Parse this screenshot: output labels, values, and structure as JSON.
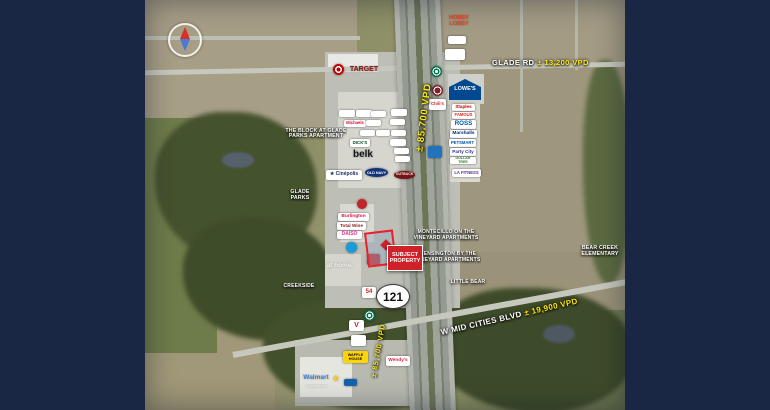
{
  "frame": {
    "side_color": "#1a2744"
  },
  "map": {
    "highway_shield": "121",
    "subject_property": {
      "label": "SUBJECT\nPROPERTY"
    },
    "traffic_labels": {
      "glade_road": "GLADE RD",
      "glade_count": "± 13,200 VPD",
      "mid_cities_road": "W MID CITIES BLVD",
      "mid_cities_count": "± 19,900 VPD",
      "highway_count": "± 85,700 VPD"
    },
    "area_labels": [
      {
        "name": "the-block-at-glade-parks-label",
        "text": "THE BLOCK AT GLADE\nPARKS APARTMENT",
        "x": 285,
        "y": 127,
        "w": 62,
        "h": 14,
        "fs": 5.2
      },
      {
        "name": "glade-parks-label",
        "text": "GLADE\nPARKS",
        "x": 286,
        "y": 189,
        "w": 28,
        "h": 13,
        "fs": 5.2
      },
      {
        "name": "creekside-label",
        "text": "CREEKSIDE",
        "x": 276,
        "y": 283,
        "w": 46,
        "h": 8,
        "fs": 5
      },
      {
        "name": "montecillo-apartments-label",
        "text": "MONTECILLO ON THE\nVINEYARD APARTMENTS",
        "x": 413,
        "y": 229,
        "w": 66,
        "h": 13,
        "fs": 5
      },
      {
        "name": "kensington-apartments-label",
        "text": "KENSINGTON BY THE\nVINEYARD APARTMENTS",
        "x": 415,
        "y": 251,
        "w": 66,
        "h": 13,
        "fs": 5
      },
      {
        "name": "little-bear-label",
        "text": "LITTLE BEAR",
        "x": 447,
        "y": 279,
        "w": 42,
        "h": 8,
        "fs": 5
      },
      {
        "name": "bear-creek-elementary-label",
        "text": "BEAR CREEK\nELEMENTARY",
        "x": 577,
        "y": 245,
        "w": 46,
        "h": 13,
        "fs": 5.2
      }
    ],
    "logos": [
      {
        "name": "target-bullseye-icon",
        "cls": "circle",
        "x": 333,
        "y": 64,
        "w": 11,
        "h": 11,
        "bg": "radial-gradient(circle,#c00000 0 2px,#ffffff 2px 3.5px,#c00000 3.5px 100%)"
      },
      {
        "name": "target-wordmark",
        "cls": "plain",
        "text": "TARGET",
        "x": 345,
        "y": 65,
        "w": 38,
        "h": 9,
        "fs": 7,
        "fg": "#8d1111"
      },
      {
        "name": "hobby-lobby-logo",
        "cls": "plain",
        "text": "HOBBY\nLOBBY",
        "x": 444,
        "y": 14,
        "w": 30,
        "h": 15,
        "fs": 5.5,
        "fg": "#e8401e"
      },
      {
        "name": "small-logo-chip",
        "cls": "chip",
        "x": 448,
        "y": 36,
        "w": 16,
        "h": 8
      },
      {
        "name": "small-logo-chip",
        "cls": "chip",
        "x": 445,
        "y": 49,
        "w": 18,
        "h": 11
      },
      {
        "name": "starbucks-logo",
        "cls": "circle",
        "x": 431,
        "y": 66,
        "w": 11,
        "h": 11,
        "bg": "radial-gradient(circle,#ffffff 0 1.5px,#00704a 1.5px 3px,#ffffff 3px 4px,#00704a 4px 100%)"
      },
      {
        "name": "torchys-logo",
        "cls": "circle",
        "x": 432,
        "y": 85,
        "w": 11,
        "h": 11,
        "bg": "radial-gradient(circle,#7d2128 0 3px,#ffffff 3px 4px,#7d2128 4px 100%)"
      },
      {
        "name": "chilis-logo",
        "cls": "chip",
        "text": "Chili's",
        "x": 429,
        "y": 99,
        "w": 15,
        "h": 11,
        "fs": 4.4,
        "fg": "#d3222a"
      },
      {
        "name": "lowes-logo",
        "cls": "house",
        "text": "LOWE'S",
        "x": 449,
        "y": 79,
        "w": 32,
        "h": 21,
        "fs": 5.5,
        "fg": "#ffffff",
        "bg": "#004990"
      },
      {
        "name": "staples-logo",
        "cls": "chip",
        "text": "Staples",
        "x": 452,
        "y": 104,
        "w": 21,
        "h": 7,
        "fs": 4.6,
        "fg": "#cc0000"
      },
      {
        "name": "famous-footwear-logo",
        "cls": "chip",
        "text": "FAMOUS",
        "x": 452,
        "y": 112,
        "w": 21,
        "h": 7,
        "fs": 4.2,
        "fg": "#d52b1e"
      },
      {
        "name": "ross-logo",
        "cls": "chip",
        "text": "ROSS",
        "x": 451,
        "y": 120,
        "w": 23,
        "h": 9,
        "fs": 6.2,
        "fg": "#0055a5"
      },
      {
        "name": "marshalls-logo",
        "cls": "chip",
        "text": "Marshalls",
        "x": 450,
        "y": 130,
        "w": 25,
        "h": 8,
        "fs": 4.8,
        "fg": "#00287a"
      },
      {
        "name": "petsmart-logo",
        "cls": "chip",
        "text": "PETSMART",
        "x": 449,
        "y": 139,
        "w": 25,
        "h": 8,
        "fs": 4.2,
        "fg": "#0054a6"
      },
      {
        "name": "party-city-logo",
        "cls": "chip",
        "text": "Party City",
        "x": 450,
        "y": 148,
        "w": 24,
        "h": 8,
        "fs": 4.6,
        "fg": "#2e3192"
      },
      {
        "name": "dollar-tree-logo",
        "cls": "chip",
        "text": "DOLLAR TREE",
        "x": 450,
        "y": 157,
        "w": 24,
        "h": 7,
        "fs": 3.6,
        "fg": "#2f7b2f"
      },
      {
        "name": "la-fitness-logo",
        "cls": "chip",
        "text": "LA FITNESS",
        "x": 452,
        "y": 169,
        "w": 27,
        "h": 8,
        "fs": 4.2,
        "fg": "#5b2d8e"
      },
      {
        "name": "shoe-dept-logo",
        "cls": "chip",
        "x": 428,
        "y": 146,
        "w": 12,
        "h": 12,
        "bg": "#1f74bd"
      },
      {
        "name": "small-logo-chip",
        "cls": "chip",
        "x": 339,
        "y": 110,
        "w": 14,
        "h": 7
      },
      {
        "name": "small-logo-chip",
        "cls": "chip",
        "x": 356,
        "y": 110,
        "w": 14,
        "h": 7
      },
      {
        "name": "small-logo-chip",
        "cls": "chip",
        "x": 371,
        "y": 111,
        "w": 13,
        "h": 6
      },
      {
        "name": "small-logo-chip",
        "cls": "chip",
        "x": 391,
        "y": 109,
        "w": 14,
        "h": 7
      },
      {
        "name": "michaels-logo",
        "cls": "chip",
        "text": "Michaels",
        "x": 344,
        "y": 120,
        "w": 20,
        "h": 7,
        "fs": 4.2,
        "fg": "#d0112b"
      },
      {
        "name": "small-logo-chip",
        "cls": "chip",
        "x": 366,
        "y": 120,
        "w": 13,
        "h": 6
      },
      {
        "name": "small-logo-chip",
        "cls": "chip",
        "x": 390,
        "y": 119,
        "w": 13,
        "h": 6
      },
      {
        "name": "small-logo-chip",
        "cls": "chip",
        "x": 360,
        "y": 130,
        "w": 13,
        "h": 6
      },
      {
        "name": "small-logo-chip",
        "cls": "chip",
        "x": 376,
        "y": 130,
        "w": 12,
        "h": 6
      },
      {
        "name": "small-logo-chip",
        "cls": "chip",
        "x": 391,
        "y": 130,
        "w": 13,
        "h": 6
      },
      {
        "name": "dicks-logo",
        "cls": "chip",
        "text": "DICK'S",
        "x": 350,
        "y": 139,
        "w": 18,
        "h": 8,
        "fs": 4.4,
        "fg": "#00482b"
      },
      {
        "name": "small-logo-chip",
        "cls": "chip",
        "x": 390,
        "y": 139,
        "w": 14,
        "h": 7
      },
      {
        "name": "small-logo-chip",
        "cls": "chip",
        "x": 394,
        "y": 148,
        "w": 13,
        "h": 6
      },
      {
        "name": "belk-logo",
        "cls": "plain",
        "text": "belk",
        "x": 350,
        "y": 149,
        "w": 26,
        "h": 13,
        "fs": 10,
        "fg": "#151515"
      },
      {
        "name": "small-logo-chip",
        "cls": "chip",
        "x": 395,
        "y": 156,
        "w": 13,
        "h": 6
      },
      {
        "name": "cinepolis-logo",
        "cls": "chip",
        "text": "★ Cinépolis",
        "x": 326,
        "y": 170,
        "w": 34,
        "h": 10,
        "fs": 5,
        "fg": "#1b2f5e"
      },
      {
        "name": "old-navy-logo",
        "cls": "oval",
        "text": "OLD NAVY",
        "x": 365,
        "y": 168,
        "w": 23,
        "h": 9,
        "fs": 3.8,
        "fg": "#ffffff",
        "bg": "#12357a"
      },
      {
        "name": "outback-logo",
        "cls": "oval",
        "text": "OUTBACK",
        "x": 394,
        "y": 171,
        "w": 21,
        "h": 8,
        "fs": 3.5,
        "fg": "#ffeedd",
        "bg": "#741418"
      },
      {
        "name": "small-logo-red",
        "cls": "circle",
        "x": 357,
        "y": 199,
        "w": 10,
        "h": 10,
        "bg": "#c32428"
      },
      {
        "name": "burlington-logo",
        "cls": "chip",
        "text": "Burlington",
        "x": 338,
        "y": 213,
        "w": 29,
        "h": 8,
        "fs": 4.8,
        "fg": "#d21942"
      },
      {
        "name": "total-wine-logo",
        "cls": "chip",
        "text": "Total Wine",
        "x": 337,
        "y": 222,
        "w": 27,
        "h": 8,
        "fs": 4.6,
        "fg": "#8d1d20"
      },
      {
        "name": "daiso-logo",
        "cls": "chip",
        "text": "DAISO",
        "x": 337,
        "y": 231,
        "w": 23,
        "h": 8,
        "fs": 5,
        "fg": "#e8368f"
      },
      {
        "name": "small-logo-blue",
        "cls": "circle",
        "x": 346,
        "y": 242,
        "w": 11,
        "h": 11,
        "bg": "#1a9cd8"
      },
      {
        "name": "at-home-logo",
        "cls": "plain",
        "text": "at home",
        "x": 322,
        "y": 261,
        "w": 34,
        "h": 10,
        "fs": 6.5,
        "fg": "#f4f2ec"
      },
      {
        "name": "small-logo-red",
        "cls": "chip",
        "x": 367,
        "y": 254,
        "w": 11,
        "h": 11,
        "bg": "#c41e25"
      },
      {
        "name": "54th-street-logo",
        "cls": "chip",
        "text": "54",
        "x": 362,
        "y": 287,
        "w": 12,
        "h": 11,
        "fs": 6,
        "fg": "#d3222a"
      },
      {
        "name": "starbucks-logo",
        "cls": "circle",
        "x": 364,
        "y": 310,
        "w": 11,
        "h": 11,
        "bg": "radial-gradient(circle,#ffffff 0 1.5px,#00704a 1.5px 3px,#ffffff 3px 4px,#00704a 4px 100%)"
      },
      {
        "name": "valvoline-logo",
        "cls": "chip",
        "text": "V",
        "x": 349,
        "y": 320,
        "w": 13,
        "h": 11,
        "fs": 7,
        "fg": "#c8102e"
      },
      {
        "name": "small-logo-chip",
        "cls": "chip",
        "x": 351,
        "y": 335,
        "w": 13,
        "h": 11
      },
      {
        "name": "waffle-house-logo",
        "cls": "chip",
        "text": "WAFFLE\nHOUSE",
        "x": 343,
        "y": 351,
        "w": 23,
        "h": 12,
        "fs": 3.8,
        "fg": "#111111",
        "bg": "#ffd400"
      },
      {
        "name": "wendys-logo",
        "cls": "chip",
        "text": "Wendy's",
        "x": 386,
        "y": 356,
        "w": 22,
        "h": 10,
        "fs": 4.8,
        "fg": "#e2203d"
      },
      {
        "name": "walmart-spark-icon",
        "cls": "plain",
        "text": "★",
        "x": 331,
        "y": 374,
        "w": 10,
        "h": 10,
        "fs": 8,
        "fg": "#ffc220"
      },
      {
        "name": "walmart-wordmark",
        "cls": "plain",
        "text": "Walmart",
        "x": 300,
        "y": 374,
        "w": 32,
        "h": 9,
        "fs": 6.5,
        "fg": "#3f83d6"
      },
      {
        "name": "walmart-supercenter-text",
        "cls": "plain",
        "text": "Supercenter",
        "x": 301,
        "y": 384,
        "w": 32,
        "h": 6,
        "fs": 3.6,
        "fg": "#e8e6e0"
      },
      {
        "name": "murphy-usa-logo",
        "cls": "chip",
        "x": 344,
        "y": 379,
        "w": 11,
        "h": 7,
        "bg": "#1460aa"
      }
    ]
  }
}
